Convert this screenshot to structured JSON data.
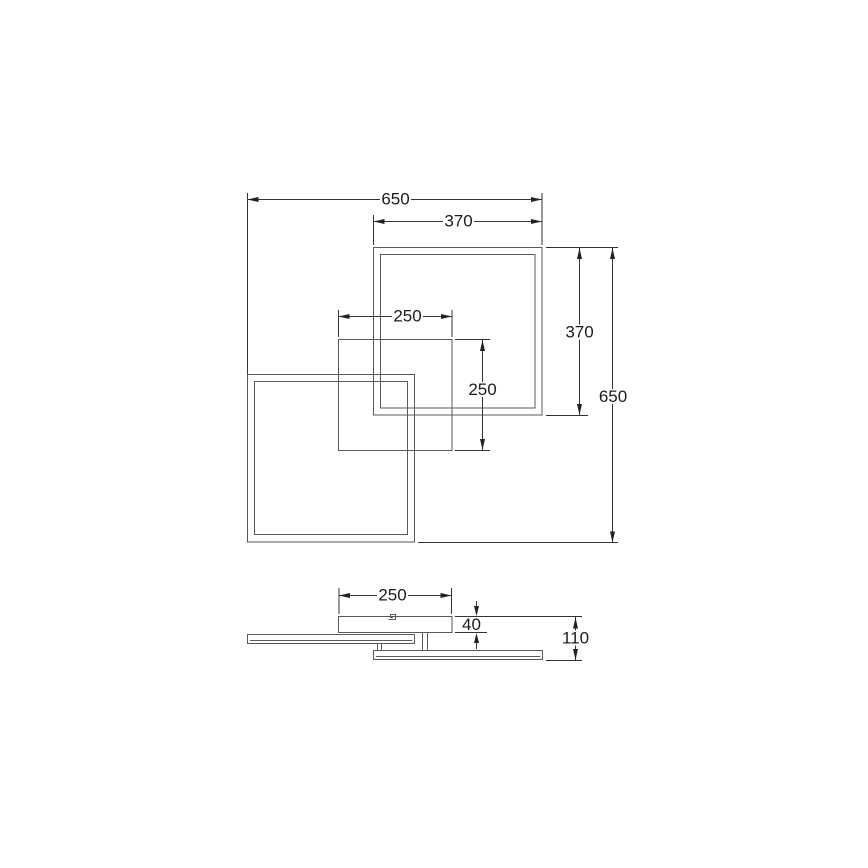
{
  "page": {
    "background": "#ffffff"
  },
  "drawing": {
    "kind": "dimensioned technical line drawing",
    "subject": "ceiling light: two overlapping square frames with square canopy, plan view and side view",
    "colors": {
      "background": "#ffffff",
      "object_line": "#5a5a5a",
      "dimension_line": "#333333",
      "text": "#1c1c1c"
    },
    "plan_view": {
      "dims": {
        "overall_width": "650",
        "upper_frame_width": "370",
        "canopy_width": "250",
        "canopy_height": "250",
        "upper_frame_height": "370",
        "overall_height": "650"
      }
    },
    "side_view": {
      "dims": {
        "canopy_width": "250",
        "canopy_height": "40",
        "overall_height": "110"
      }
    }
  }
}
